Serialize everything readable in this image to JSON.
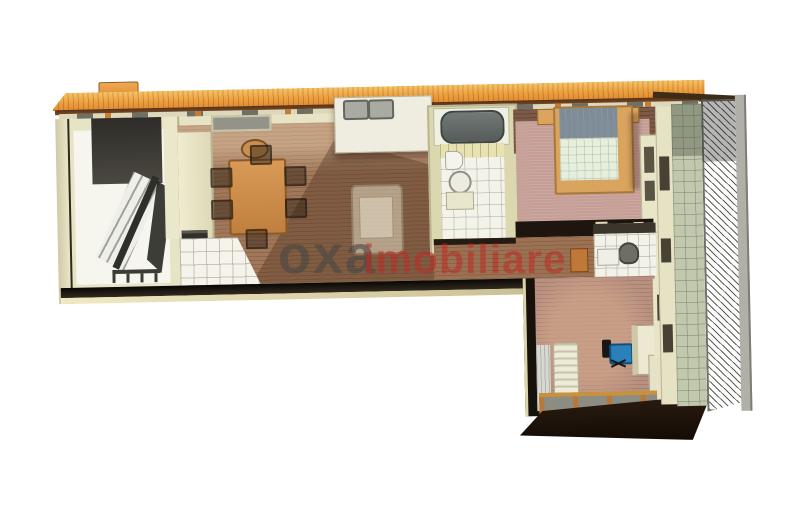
{
  "render": {
    "style": "3D cutaway dollhouse floor plan of an L-shaped apartment, top-down oblique view",
    "background": "#ffffff"
  },
  "watermark": {
    "brand": "oxa",
    "suffix": "imobiliare",
    "brand_color": "rgba(72,70,68,0.60)",
    "suffix_color": "rgba(186,44,38,0.58)"
  },
  "palette": {
    "roof_tile_light": "#f6c468",
    "roof_tile_dark": "#e08a32",
    "roof_fascia": "#56321a",
    "interior_wall_cream": "#e7e4c6",
    "wood_floor_living": "#a1775a",
    "bedroom_carpet": "#c59e96",
    "office_floor": "#b89080",
    "white_tile": "#f4f3ea",
    "balcony_tile": "#c2c8ae",
    "section_cut_dark": "#17110c",
    "bed_wood": "#d9a45e",
    "pillow_gray_blue": "#7e8c98",
    "blanket_mint": "#e6eedd",
    "bathtub_gray": "#565c5a",
    "office_chair_blue": "#2a80ba",
    "hall_cabinet_orange": "#c07838"
  },
  "inventory": {
    "rooms": [
      "stairwell with staircase and bench",
      "living-dining room with wood floor",
      "kitchen corner with tiled floor and counters",
      "bathroom with tub, toilet and basin",
      "bedroom with double bed and wardrobe",
      "hallway with small cabinet",
      "wc with toilet and sink",
      "office room with desk and blue chair",
      "balcony with hatched railing along right side"
    ],
    "furniture": [
      "dining table",
      "six dining chairs",
      "pendant lamp",
      "armchair",
      "kitchen counter with double sink",
      "stove",
      "bathtub",
      "toilet",
      "round basin",
      "double bed",
      "two nightstands",
      "wardrobe",
      "hall cabinet",
      "wc toilet",
      "wc sink",
      "radiator",
      "curtain",
      "office desk",
      "blue office chair",
      "stair railing",
      "entry bench"
    ]
  }
}
